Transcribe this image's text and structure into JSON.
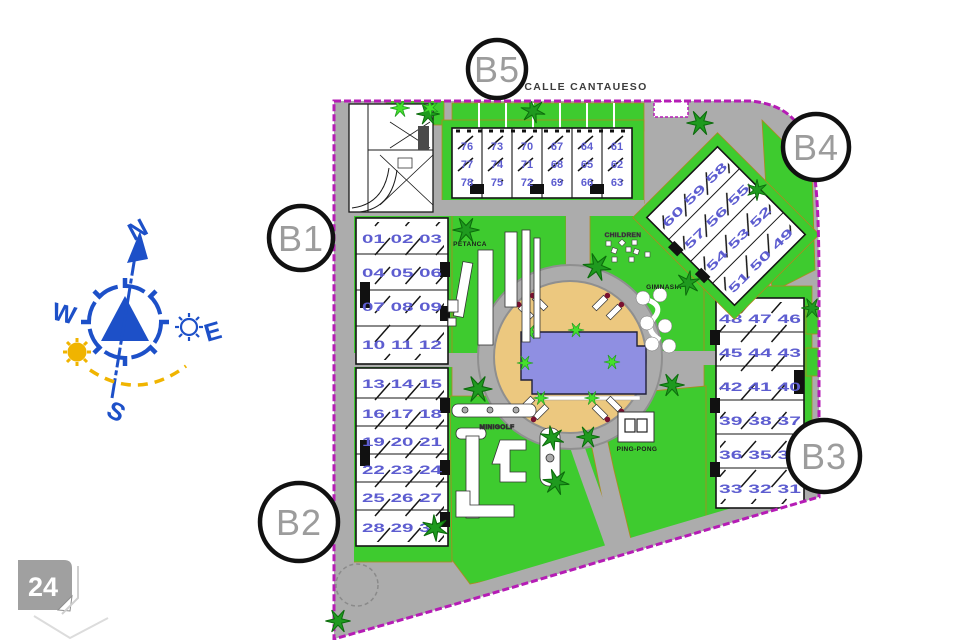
{
  "plan": {
    "street_label": "CALLE CANTAUESO",
    "page_badge": "24",
    "amenities": {
      "petanca": "PETANCA",
      "children": "CHILDREN",
      "gimnasia": "GIMNASIA",
      "minigolf": "MINIGOLF",
      "pingpong": "PING-PONG"
    },
    "compass": {
      "n": "N",
      "s": "S",
      "e": "E",
      "w": "W"
    },
    "blocks": {
      "b1": {
        "label": "B1",
        "rows": [
          [
            "01",
            "02",
            "03"
          ],
          [
            "04",
            "05",
            "06"
          ],
          [
            "07",
            "08",
            "09"
          ],
          [
            "10",
            "11",
            "12"
          ]
        ]
      },
      "b2": {
        "label": "B2",
        "rows": [
          [
            "13",
            "14",
            "15"
          ],
          [
            "16",
            "17",
            "18"
          ],
          [
            "19",
            "20",
            "21"
          ],
          [
            "22",
            "23",
            "24"
          ],
          [
            "25",
            "26",
            "27"
          ],
          [
            "28",
            "29",
            "30"
          ]
        ]
      },
      "b3": {
        "label": "B3",
        "rows": [
          [
            "48",
            "47",
            "46"
          ],
          [
            "45",
            "44",
            "43"
          ],
          [
            "42",
            "41",
            "40"
          ],
          [
            "39",
            "38",
            "37"
          ],
          [
            "36",
            "35",
            "34"
          ],
          [
            "33",
            "32",
            "31"
          ]
        ]
      },
      "b4": {
        "label": "B4",
        "rows": [
          [
            "60",
            "59",
            "58"
          ],
          [
            "57",
            "56",
            "55"
          ],
          [
            "54",
            "53",
            "52"
          ],
          [
            "51",
            "50",
            "49"
          ]
        ]
      },
      "b5": {
        "label": "B5",
        "columns": [
          [
            "76",
            "77",
            "78"
          ],
          [
            "73",
            "74",
            "75"
          ],
          [
            "70",
            "71",
            "72"
          ],
          [
            "67",
            "68",
            "69"
          ],
          [
            "64",
            "65",
            "66"
          ],
          [
            "61",
            "62",
            "63"
          ]
        ]
      }
    },
    "colors": {
      "lawn": "#3ecb2f",
      "plant_dark": "#1f9a1f",
      "road": "#acacac",
      "boundary": "#b51cb5",
      "deck": "#ecc87f",
      "pool": "#8f8fe2",
      "unit_number": "#5d5dd0",
      "compass_blue": "#1d50c8",
      "sun_yellow": "#f0b400",
      "badge_gray": "#a0a0a0"
    }
  }
}
